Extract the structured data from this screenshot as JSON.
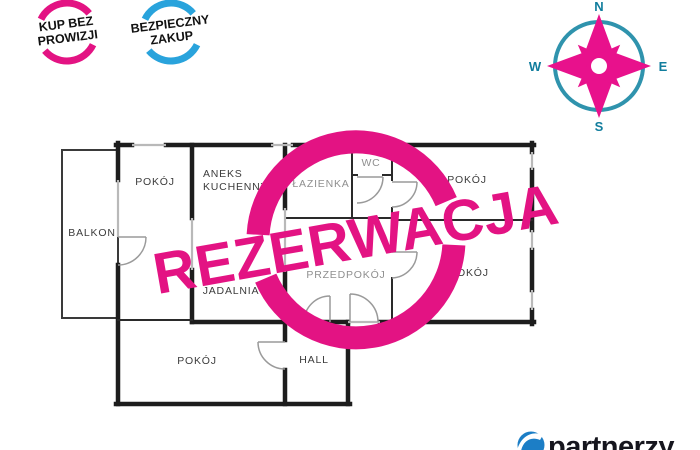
{
  "badges": {
    "buy_no_commission": {
      "line1": "KUP BEZ",
      "line2": "PROWIZJI",
      "ring_color": "#e31383"
    },
    "safe_purchase": {
      "line1": "BEZPIECZNY",
      "line2": "ZAKUP",
      "ring_color": "#29a3dc"
    }
  },
  "compass": {
    "n": "N",
    "e": "E",
    "s": "S",
    "w": "W",
    "star_color": "#e8118c",
    "ring_color": "#2f93ad"
  },
  "stamp": {
    "text": "REZERWACJA",
    "color": "#e31383"
  },
  "floor_plan": {
    "rooms": {
      "balkon": {
        "label": "BALKON"
      },
      "pokoj_top_left": {
        "label": "POKÓJ"
      },
      "aneks_kuchenny": {
        "label_line1": "ANEKS",
        "label_line2": "KUCHENNY"
      },
      "lazienka": {
        "label": "ŁAZIENKA"
      },
      "wc": {
        "label": "WC"
      },
      "pokoj_top_right": {
        "label": "POKÓJ"
      },
      "jadalnia": {
        "label": "JADALNIA"
      },
      "przedpokoj": {
        "label": "PRZEDPOKÓJ"
      },
      "pokoj_bottom_right": {
        "label": "POKÓJ"
      },
      "pokoj_bottom": {
        "label": "POKÓJ"
      },
      "hall": {
        "label": "HALL"
      }
    }
  },
  "logo": {
    "text": "partnerzy",
    "icon_color": "#1c7ec6"
  },
  "colors": {
    "wall_black": "#1d1d1d",
    "door_gray": "#9a9a9a",
    "label_dark": "#3c3c3c",
    "label_gray": "#8f8f8f"
  }
}
